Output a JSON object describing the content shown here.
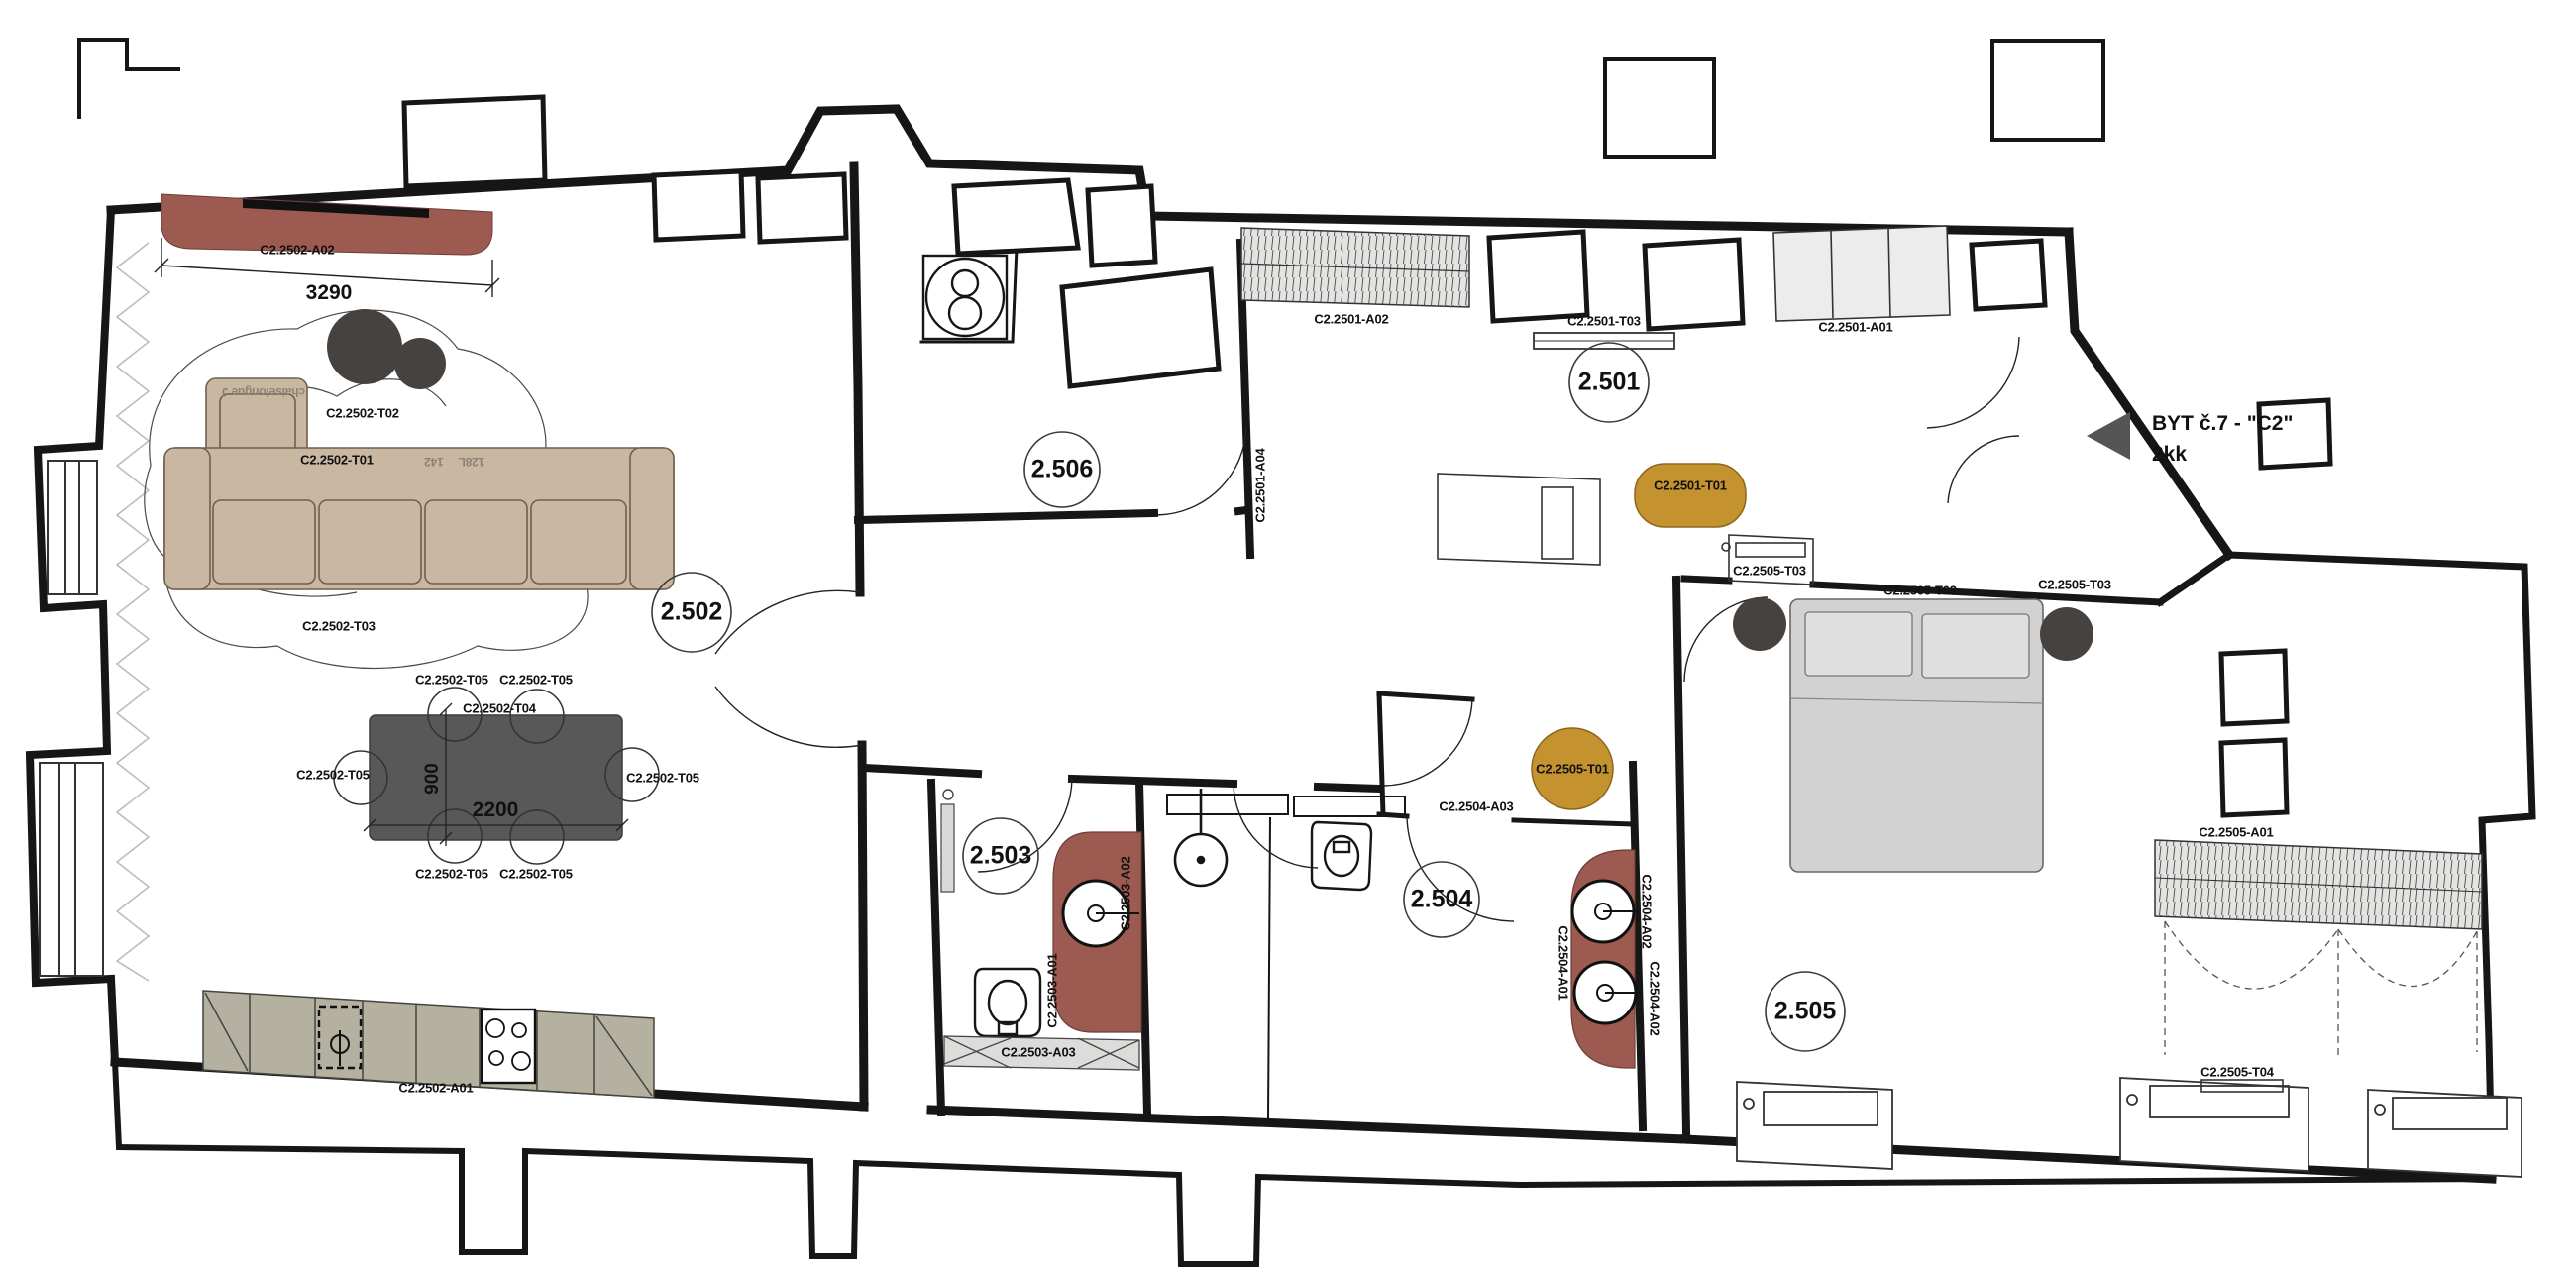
{
  "plan": {
    "flat_title": "BYT č.7 - \"C2\"",
    "flat_layout": "2kk"
  },
  "rooms": {
    "hall": "2.501",
    "living": "2.502",
    "bathroom": "2.503",
    "wc": "2.504",
    "bedroom": "2.505",
    "utility": "2.506"
  },
  "dims": {
    "curtain_width": "3290",
    "table_length": "2200",
    "table_depth": "900"
  },
  "codes": {
    "living_curtain": "C2.2502-A02",
    "living_sofa": "C2.2502-T01",
    "living_plant": "C2.2502-T02",
    "living_rug": "C2.2502-T03",
    "living_table": "C2.2502-T04",
    "living_chair": "C2.2502-T05",
    "kitchen_counter": "C2.2502-A01",
    "hall_wardrobe": "C2.2501-A02",
    "hall_sideboard": "C2.2501-T03",
    "hall_entry_wardrobe": "C2.2501-A01",
    "hall_pouf": "C2.2501-T01",
    "hall_partition": "C2.2501-A04",
    "bed_nightstand": "C2.2505-T03",
    "bed": "C2.2505-T02",
    "bedroom_pouf": "C2.2505-T01",
    "bedroom_wardrobe": "C2.2505-A01",
    "bedroom_bench": "C2.2505-T04",
    "bath_vanity": "C2.2503-A01",
    "bath_wall_finish": "C2.2503-A02",
    "bath_cabinet": "C2.2503-A03",
    "wc_wall_finish": "C2.2504-A03",
    "wc_vanity": "C2.2504-A01",
    "wc_vanity_top": "C2.2504-A02"
  },
  "sofa_annotations": {
    "chaise": "chaiselongue J",
    "module_a": "142",
    "module_b": "128L"
  },
  "colors": {
    "wall": "#161616",
    "accent_red": "#9c5a50",
    "accent_mustard": "#c4922f",
    "sofa_beige": "#c9b7a2",
    "counter_grey": "#b5b1a0",
    "table_dark": "#585858",
    "bed_grey": "#d2d2d2",
    "plant_dark": "#46423f",
    "hatch_grey": "#e3e3e1"
  }
}
